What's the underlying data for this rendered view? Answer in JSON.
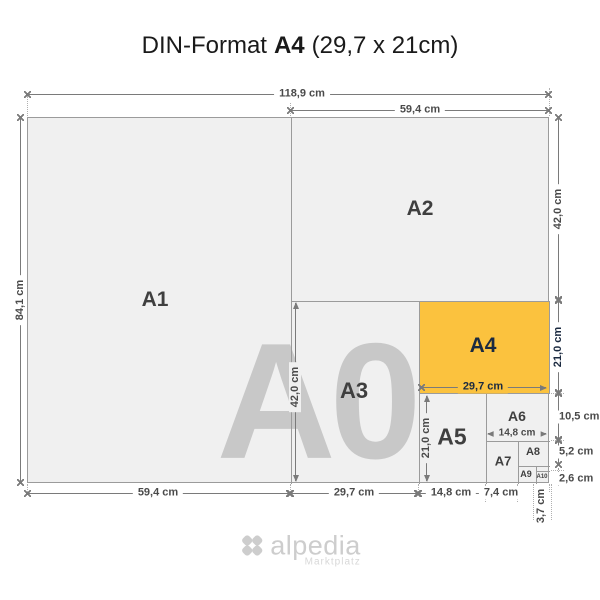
{
  "title": {
    "prefix": "DIN-Format",
    "emphasis": "A4",
    "suffix": "(29,7 x 21cm)"
  },
  "watermark": "A0",
  "panel_labels": {
    "a1": "A1",
    "a2": "A2",
    "a3": "A3",
    "a4": "A4",
    "a5": "A5",
    "a6": "A6",
    "a7": "A7",
    "a8": "A8",
    "a9": "A9",
    "a10": "A10"
  },
  "dim_labels": {
    "top_width_full": "118,9 cm",
    "top_width_half": "59,4 cm",
    "left_height_full": "84,1 cm",
    "right_height_a2": "42,0 cm",
    "right_height_a4": "21,0 cm",
    "right_height_a6": "10,5 cm",
    "right_height_a8": "5,2 cm",
    "right_height_a10": "2,6 cm",
    "bottom_width_a1": "59,4 cm",
    "bottom_width_a3": "29,7 cm",
    "bottom_width_a5": "14,8 cm",
    "bottom_width_a7": "7,4 cm",
    "bottom_width_a9": "3,7 cm",
    "inner_height_a3": "42,0 cm",
    "inner_height_a5": "21,0 cm",
    "inner_width_a4": "29,7 cm",
    "inner_width_a6": "14,8 cm"
  },
  "colors": {
    "highlight_yellow": "#FBC23E",
    "paper_gray": "#F0F0F0",
    "watermark_gray": "#C8C8C8",
    "grid_line": "#9B9B9B",
    "dim_line": "#7A7A7A",
    "label_dark": "#3F3F3F",
    "a4_navy": "#1B2A40"
  },
  "logo": {
    "name": "alpedia",
    "subtitle": "Marktplatz"
  }
}
